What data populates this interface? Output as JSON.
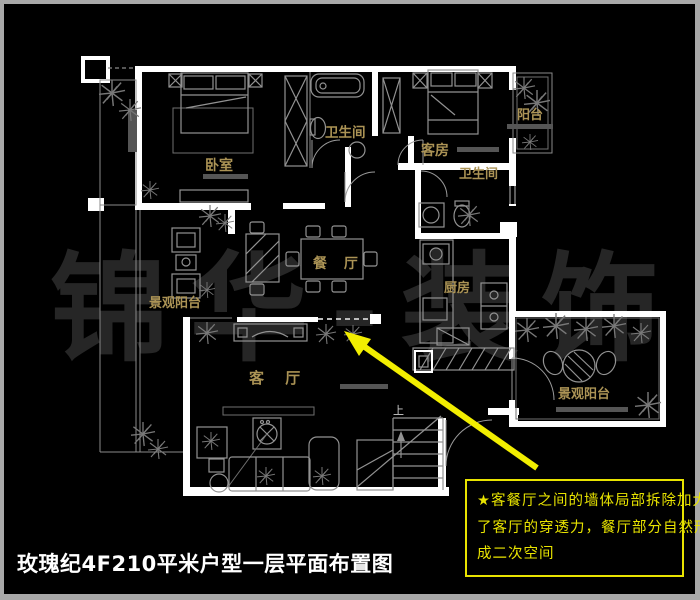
{
  "frame": {
    "border_color": "#a8a8a8",
    "background": "#000000"
  },
  "watermark": {
    "text": "锦华-装饰",
    "color": "#262626"
  },
  "title": {
    "text": "玫瑰纪4F210平米户型一层平面布置图",
    "color": "#ffffff"
  },
  "plan": {
    "wall_color": "#ffffff",
    "furniture_color": "#929292",
    "label_color": "#ab9355",
    "highlight_color": "#f2ee00",
    "rooms": {
      "bedroom": "卧室",
      "bathroom_top": "卫生间",
      "guest_room": "客房",
      "balcony_top": "阳台",
      "bathroom_mid": "卫生间",
      "dining": "餐 厅",
      "kitchen": "厨房",
      "view_balcony_left": "景观阳台",
      "living": "客 厅",
      "view_balcony_right": "景观阳台",
      "stairs_up": "上"
    }
  },
  "callout": {
    "border_color": "#e8e300",
    "line1": "★客餐厅之间的墙体局部拆除加大",
    "line2": "了客厅的穿透力，餐厅部分自然形",
    "line3": "成二次空间"
  }
}
